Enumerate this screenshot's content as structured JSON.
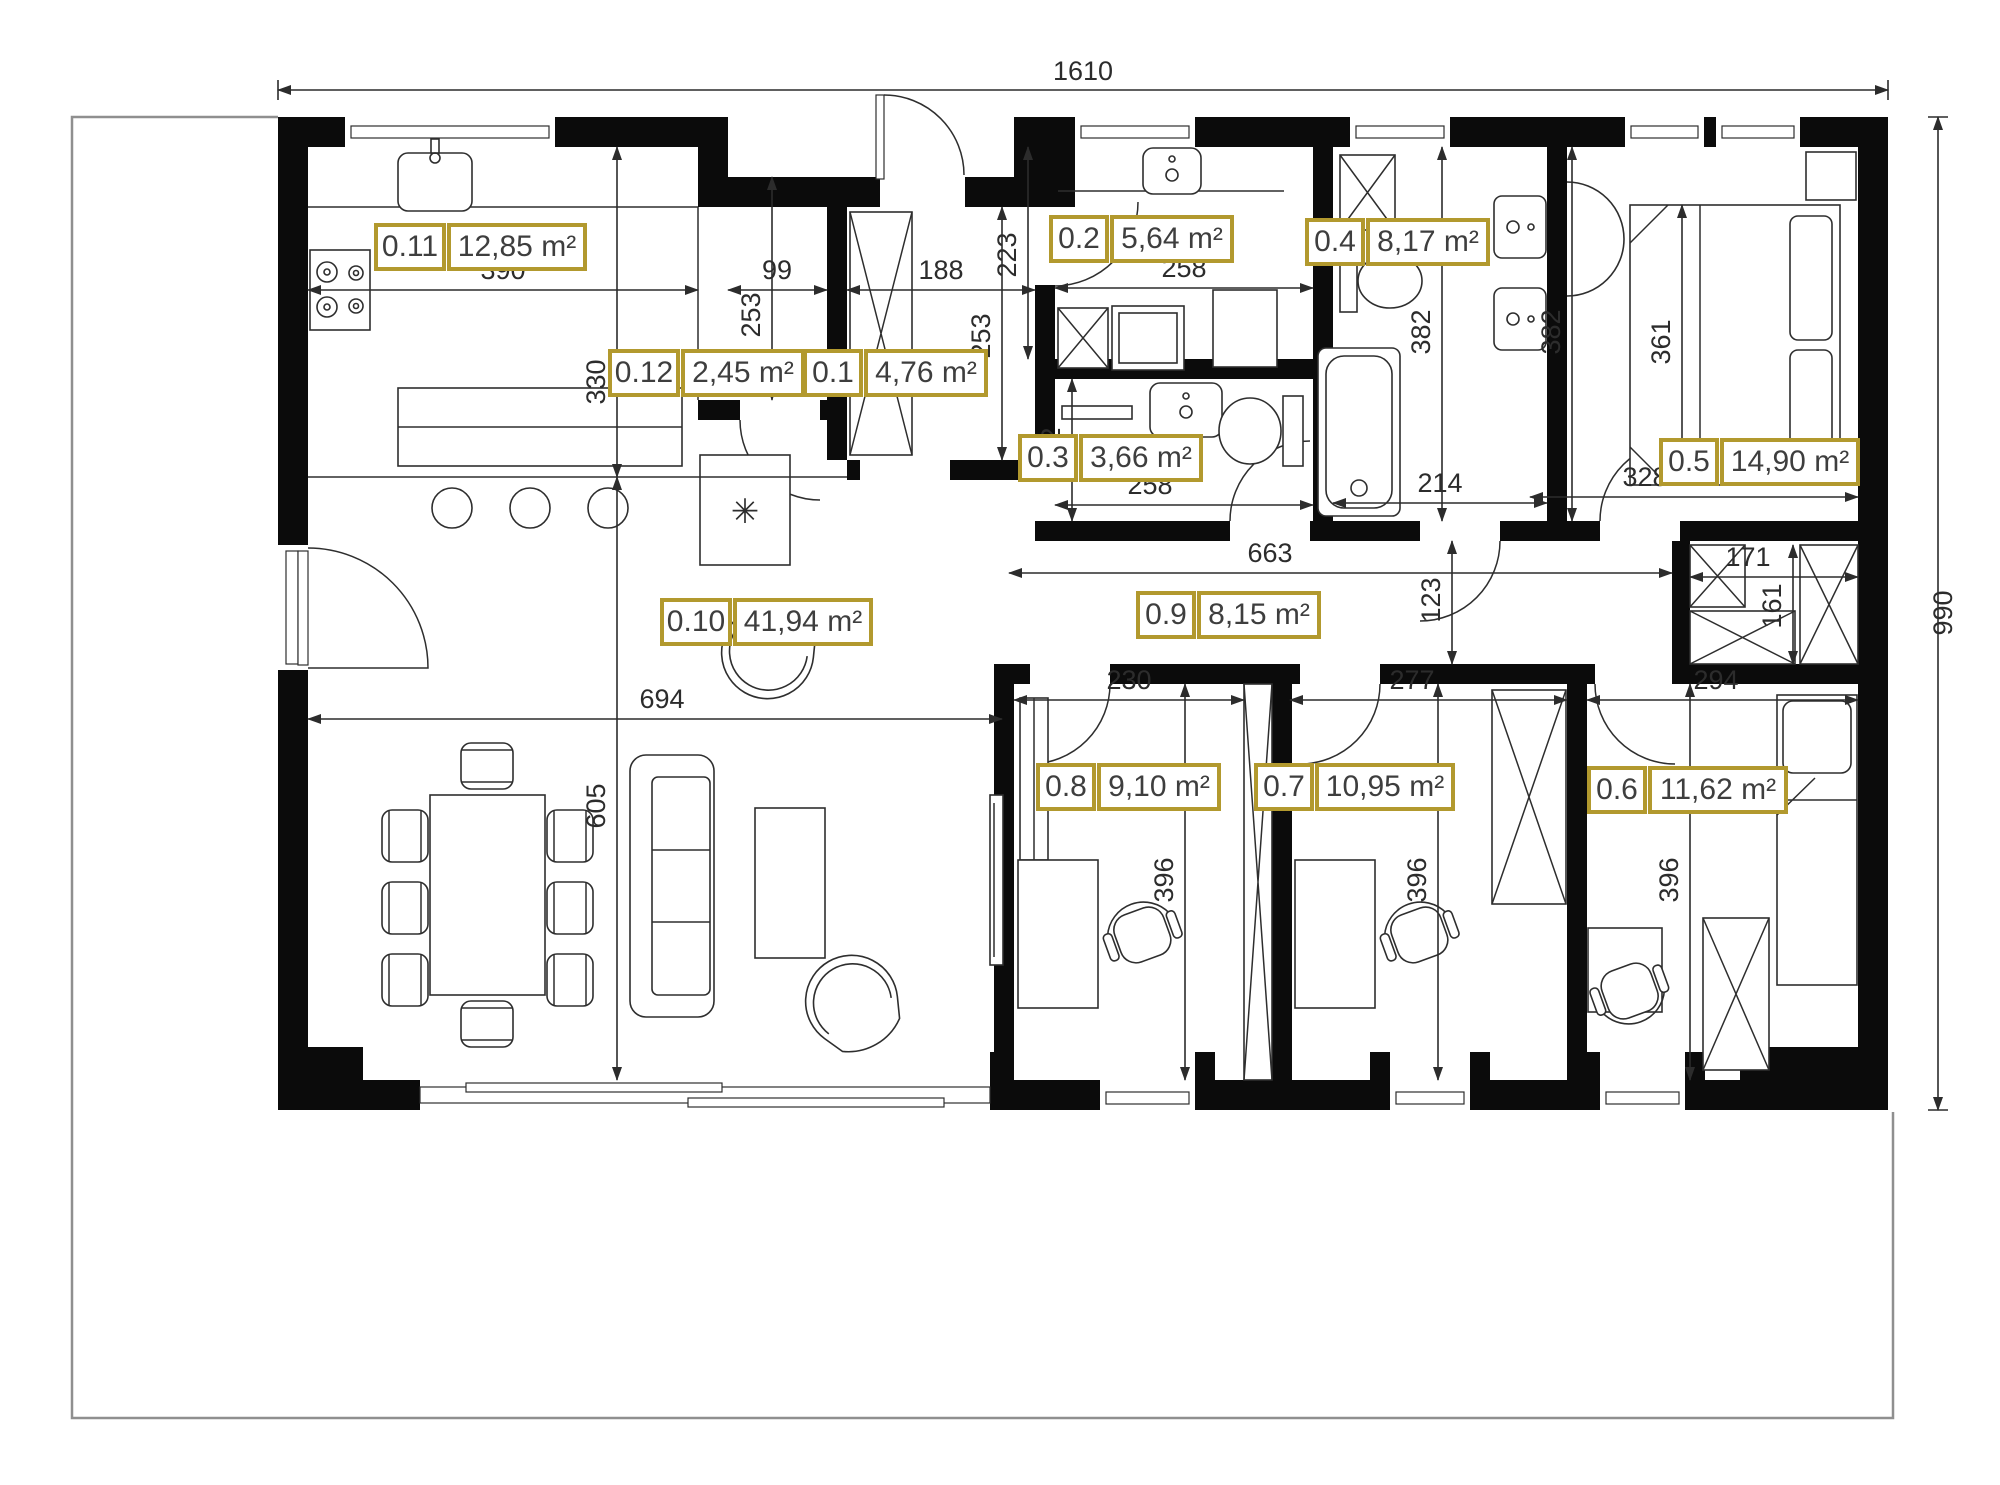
{
  "colors": {
    "accent_gold": "#b2992e",
    "label_text": "#3e3e3e",
    "wall_black": "#0b0b0b",
    "dim_line": "#2c2c2c",
    "boundary_gray": "#8f8f8f"
  },
  "rooms": [
    {
      "id": "0.1",
      "area": "4,76 m²"
    },
    {
      "id": "0.2",
      "area": "5,64 m²"
    },
    {
      "id": "0.3",
      "area": "3,66 m²"
    },
    {
      "id": "0.4",
      "area": "8,17 m²"
    },
    {
      "id": "0.5",
      "area": "14,90 m²"
    },
    {
      "id": "0.6",
      "area": "11,62 m²"
    },
    {
      "id": "0.7",
      "area": "10,95 m²"
    },
    {
      "id": "0.8",
      "area": "9,10 m²"
    },
    {
      "id": "0.9",
      "area": "8,15 m²"
    },
    {
      "id": "0.10",
      "area": "41,94 m²"
    },
    {
      "id": "0.11",
      "area": "12,85 m²"
    },
    {
      "id": "0.12",
      "area": "2,45 m²"
    }
  ],
  "dims": {
    "total_w": "1610",
    "total_h": "990",
    "kitchen_w": "390",
    "kitchen_h": "330",
    "pantry_w": "99",
    "pantry_h": "253",
    "hall_w": "188",
    "hall_h": "253",
    "bath2_h": "223",
    "bath2_w": "258",
    "wc_h": "142",
    "wc_w": "258",
    "bath4_w": "214",
    "bath4_h": "382",
    "bed5_h": "382",
    "bed5_bed": "361",
    "bed5_w": "328",
    "corr_w": "663",
    "corr_h": "123",
    "closet_w": "171",
    "closet_h": "161",
    "living_w": "694",
    "living_h": "605",
    "room8_w": "230",
    "room7_w": "277",
    "room6_w": "294",
    "room8_h": "396",
    "room7_h": "396",
    "room6_h": "396"
  },
  "icons": {
    "freezer": "✳"
  }
}
